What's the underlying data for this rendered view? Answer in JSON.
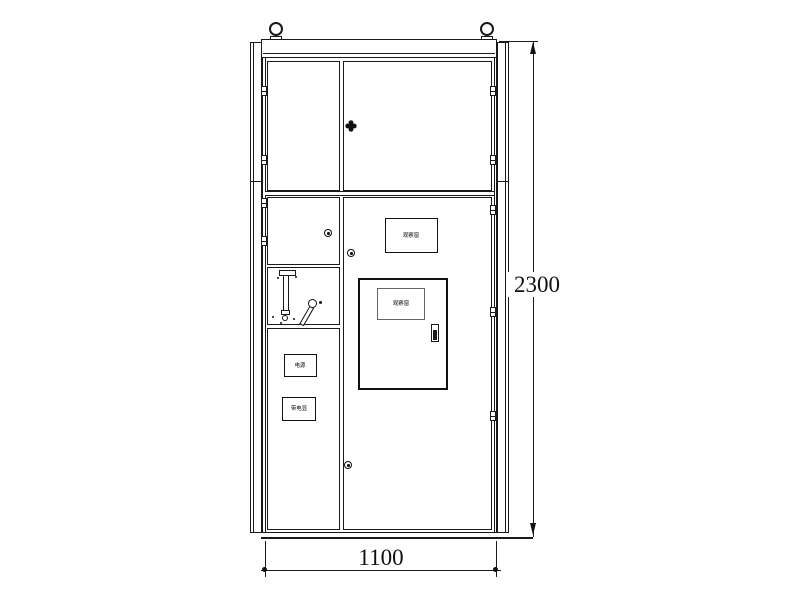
{
  "colors": {
    "background": "#ffffff",
    "line": "#1a1a1a"
  },
  "dimensions": {
    "width_mm": "1100",
    "height_mm": "2300"
  },
  "cabinet": {
    "upper_door_window_label": "观察窗",
    "inner_door_window_label": "观察窗",
    "left_panel_top_label": "电源",
    "left_panel_bottom_label": "带电显"
  }
}
